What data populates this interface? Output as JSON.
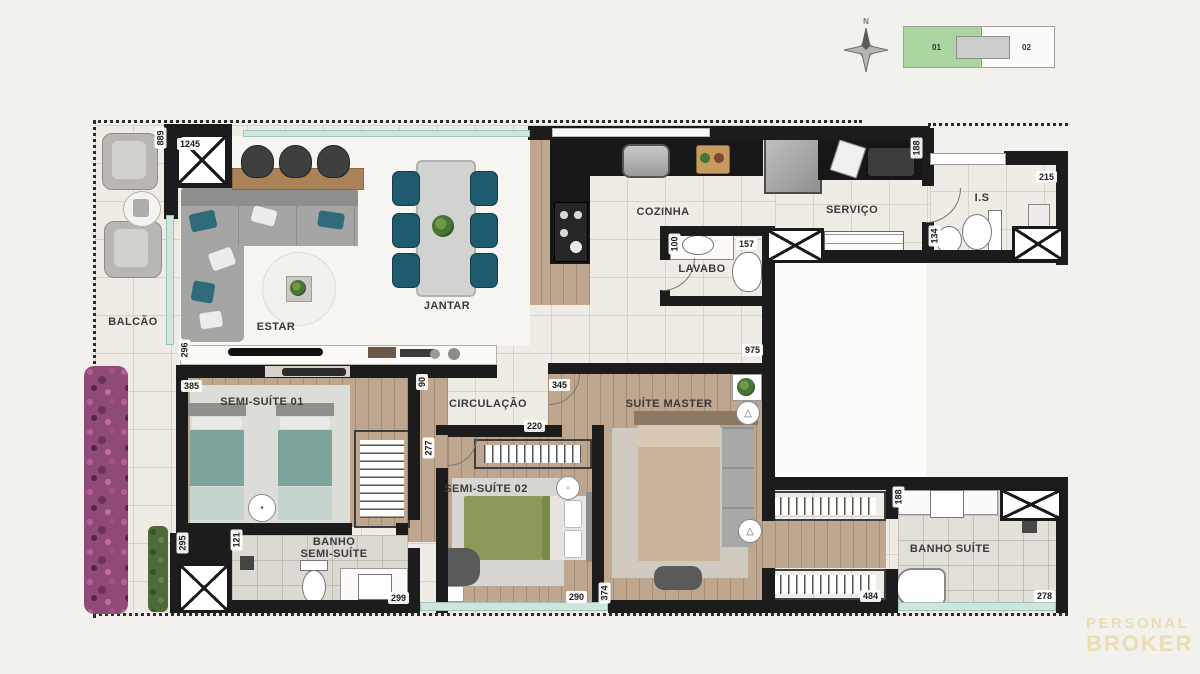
{
  "rooms": {
    "balcao": "BALCÃO",
    "estar": "ESTAR",
    "jantar": "JANTAR",
    "cozinha": "COZINHA",
    "lavabo": "LAVABO",
    "servico": "SERVIÇO",
    "is": "I.S",
    "semi_suite_01": "SEMI-SUÍTE 01",
    "circulacao": "CIRCULAÇÃO",
    "semi_suite_02": "SEMI-SUÍTE 02",
    "suite_master": "SUÍTE MASTER",
    "banho_semi_suite_l1": "BANHO",
    "banho_semi_suite_l2": "SEMI-SUÍTE",
    "banho_suite": "BANHO SUÍTE"
  },
  "dims": {
    "balcao_depth": "889",
    "social_width": "1245",
    "console_depth": "296",
    "semi_suite_01_width": "385",
    "door_pass": "90",
    "corridor_length": "975",
    "suite_master_width": "345",
    "lavabo_width": "100",
    "lavabo_length": "157",
    "servico_depth": "188",
    "is_length": "215",
    "is_depth": "134",
    "shaft_depth": "295",
    "banho_ss_depth": "121",
    "banho_ss_length": "299",
    "hall_depth": "277",
    "ss2_opening": "220",
    "ss2_width": "290",
    "ss2_depth": "374",
    "closet_length": "484",
    "banho_suite_depth": "188",
    "banho_suite_length": "278"
  },
  "keyplan": {
    "unit_left": "01",
    "unit_right": "02",
    "highlight_color": "#abd6a0"
  },
  "compass": {
    "north_label": "N"
  },
  "watermark": {
    "line1": "PERSONAL",
    "line2": "BROKER",
    "color": "#eadfb2"
  },
  "colors": {
    "wall": "#1c1c1c",
    "counter": "#171717",
    "chair_teal": "#1f5b6e",
    "bed_teal": "#7ca49a",
    "bed_olive": "#8a9b59",
    "wood": "#bfa78f"
  }
}
